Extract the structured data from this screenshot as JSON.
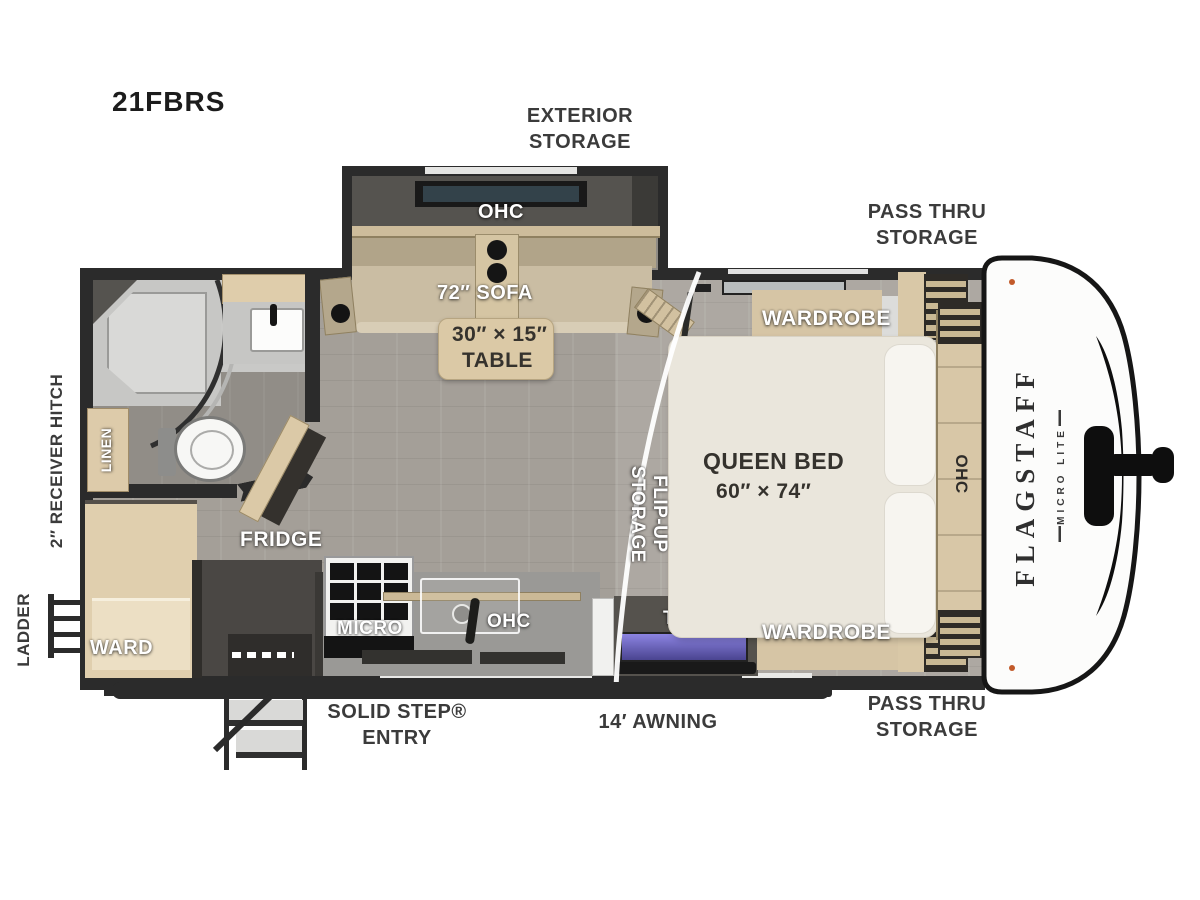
{
  "model": "21FBRS",
  "brand": {
    "name": "FLAGSTAFF",
    "sub": "MICRO LITE"
  },
  "exterior": {
    "exterior_storage": "EXTERIOR STORAGE",
    "pass_thru_top": "PASS THRU STORAGE",
    "pass_thru_bottom": "PASS THRU STORAGE",
    "receiver_hitch": "2″ RECEIVER HITCH",
    "ladder": "LADDER",
    "solid_step": "SOLID STEP® ENTRY",
    "awning": "14′ AWNING"
  },
  "living": {
    "slide_ohc": "OHC",
    "sofa": "72″ SOFA",
    "table_size": "30″ × 15″",
    "table_word": "TABLE",
    "flip_up": "FLIP-UP STORAGE"
  },
  "kitchen": {
    "micro": "MICRO",
    "ohc": "OHC",
    "fridge": "FRIDGE"
  },
  "bedroom": {
    "wardrobe_top": "WARDROBE",
    "wardrobe_bottom": "WARDROBE",
    "bed_name": "QUEEN BED",
    "bed_size": "60″ × 74″",
    "tv": "TV",
    "front_ohc": "OHC"
  },
  "bath": {
    "linen": "LINEN"
  },
  "entry": {
    "ward": "WARD"
  },
  "colors": {
    "wall": "#2b2b2b",
    "cabinet": "#d9c8a7",
    "accent_screen": "#8c84e2"
  }
}
